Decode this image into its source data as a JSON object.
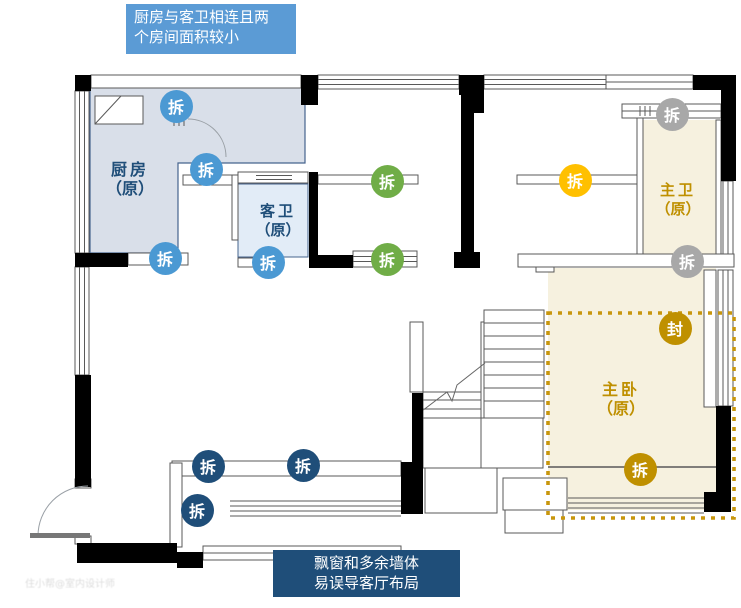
{
  "annotations": {
    "top_note": {
      "text_lines": [
        "厨房与客卫相连且两",
        "个房间面积较小"
      ],
      "bg_color": "#5B9BD5",
      "text_color": "#FFFFFF"
    },
    "bottom_note": {
      "text_lines": [
        "飘窗和多余墙体",
        "易误导客厅布局"
      ],
      "bg_color": "#1F4E79",
      "text_color": "#FFFFFF"
    }
  },
  "rooms": {
    "kitchen": {
      "name": "厨房",
      "status": "（原）",
      "text_color": "#1F4E79",
      "fill": "#D9DFE9"
    },
    "guest_bath": {
      "name": "客卫",
      "status": "（原）",
      "text_color": "#1F4E79",
      "fill": "#E2ECF7"
    },
    "master_bath": {
      "name": "主卫",
      "status": "（原）",
      "text_color": "#BF9000",
      "fill": "#F6F1DF"
    },
    "master_bed": {
      "name": "主卧",
      "status": "（原）",
      "text_color": "#BF9000",
      "fill": "#F6F1DF"
    }
  },
  "badges": [
    {
      "label": "拆",
      "type": "demolish-blue",
      "color": "#4B99D3",
      "x": 176,
      "y": 106
    },
    {
      "label": "拆",
      "type": "demolish-blue",
      "color": "#4B99D3",
      "x": 206,
      "y": 169
    },
    {
      "label": "拆",
      "type": "demolish-blue",
      "color": "#4B99D3",
      "x": 165,
      "y": 258
    },
    {
      "label": "拆",
      "type": "demolish-blue",
      "color": "#4B99D3",
      "x": 268,
      "y": 262
    },
    {
      "label": "拆",
      "type": "demolish-green",
      "color": "#70AD47",
      "x": 387,
      "y": 181
    },
    {
      "label": "拆",
      "type": "demolish-green",
      "color": "#70AD47",
      "x": 387,
      "y": 259
    },
    {
      "label": "拆",
      "type": "demolish-yellow",
      "color": "#FFC000",
      "x": 575,
      "y": 180
    },
    {
      "label": "拆",
      "type": "demolish-gray",
      "color": "#A8A8A8",
      "x": 672,
      "y": 114
    },
    {
      "label": "拆",
      "type": "demolish-gray",
      "color": "#A8A8A8",
      "x": 687,
      "y": 261
    },
    {
      "label": "封",
      "type": "seal-gold",
      "color": "#BF9000",
      "x": 675,
      "y": 328
    },
    {
      "label": "拆",
      "type": "demolish-gold",
      "color": "#BF9000",
      "x": 640,
      "y": 469
    },
    {
      "label": "拆",
      "type": "demolish-navy",
      "color": "#1F4E79",
      "x": 208,
      "y": 466
    },
    {
      "label": "拆",
      "type": "demolish-navy",
      "color": "#1F4E79",
      "x": 303,
      "y": 465
    },
    {
      "label": "拆",
      "type": "demolish-navy",
      "color": "#1F4E79",
      "x": 197,
      "y": 510
    }
  ],
  "highlight_box": {
    "color": "#C8960C",
    "style": "dotted"
  },
  "watermark": "住小帮@室内设计师"
}
